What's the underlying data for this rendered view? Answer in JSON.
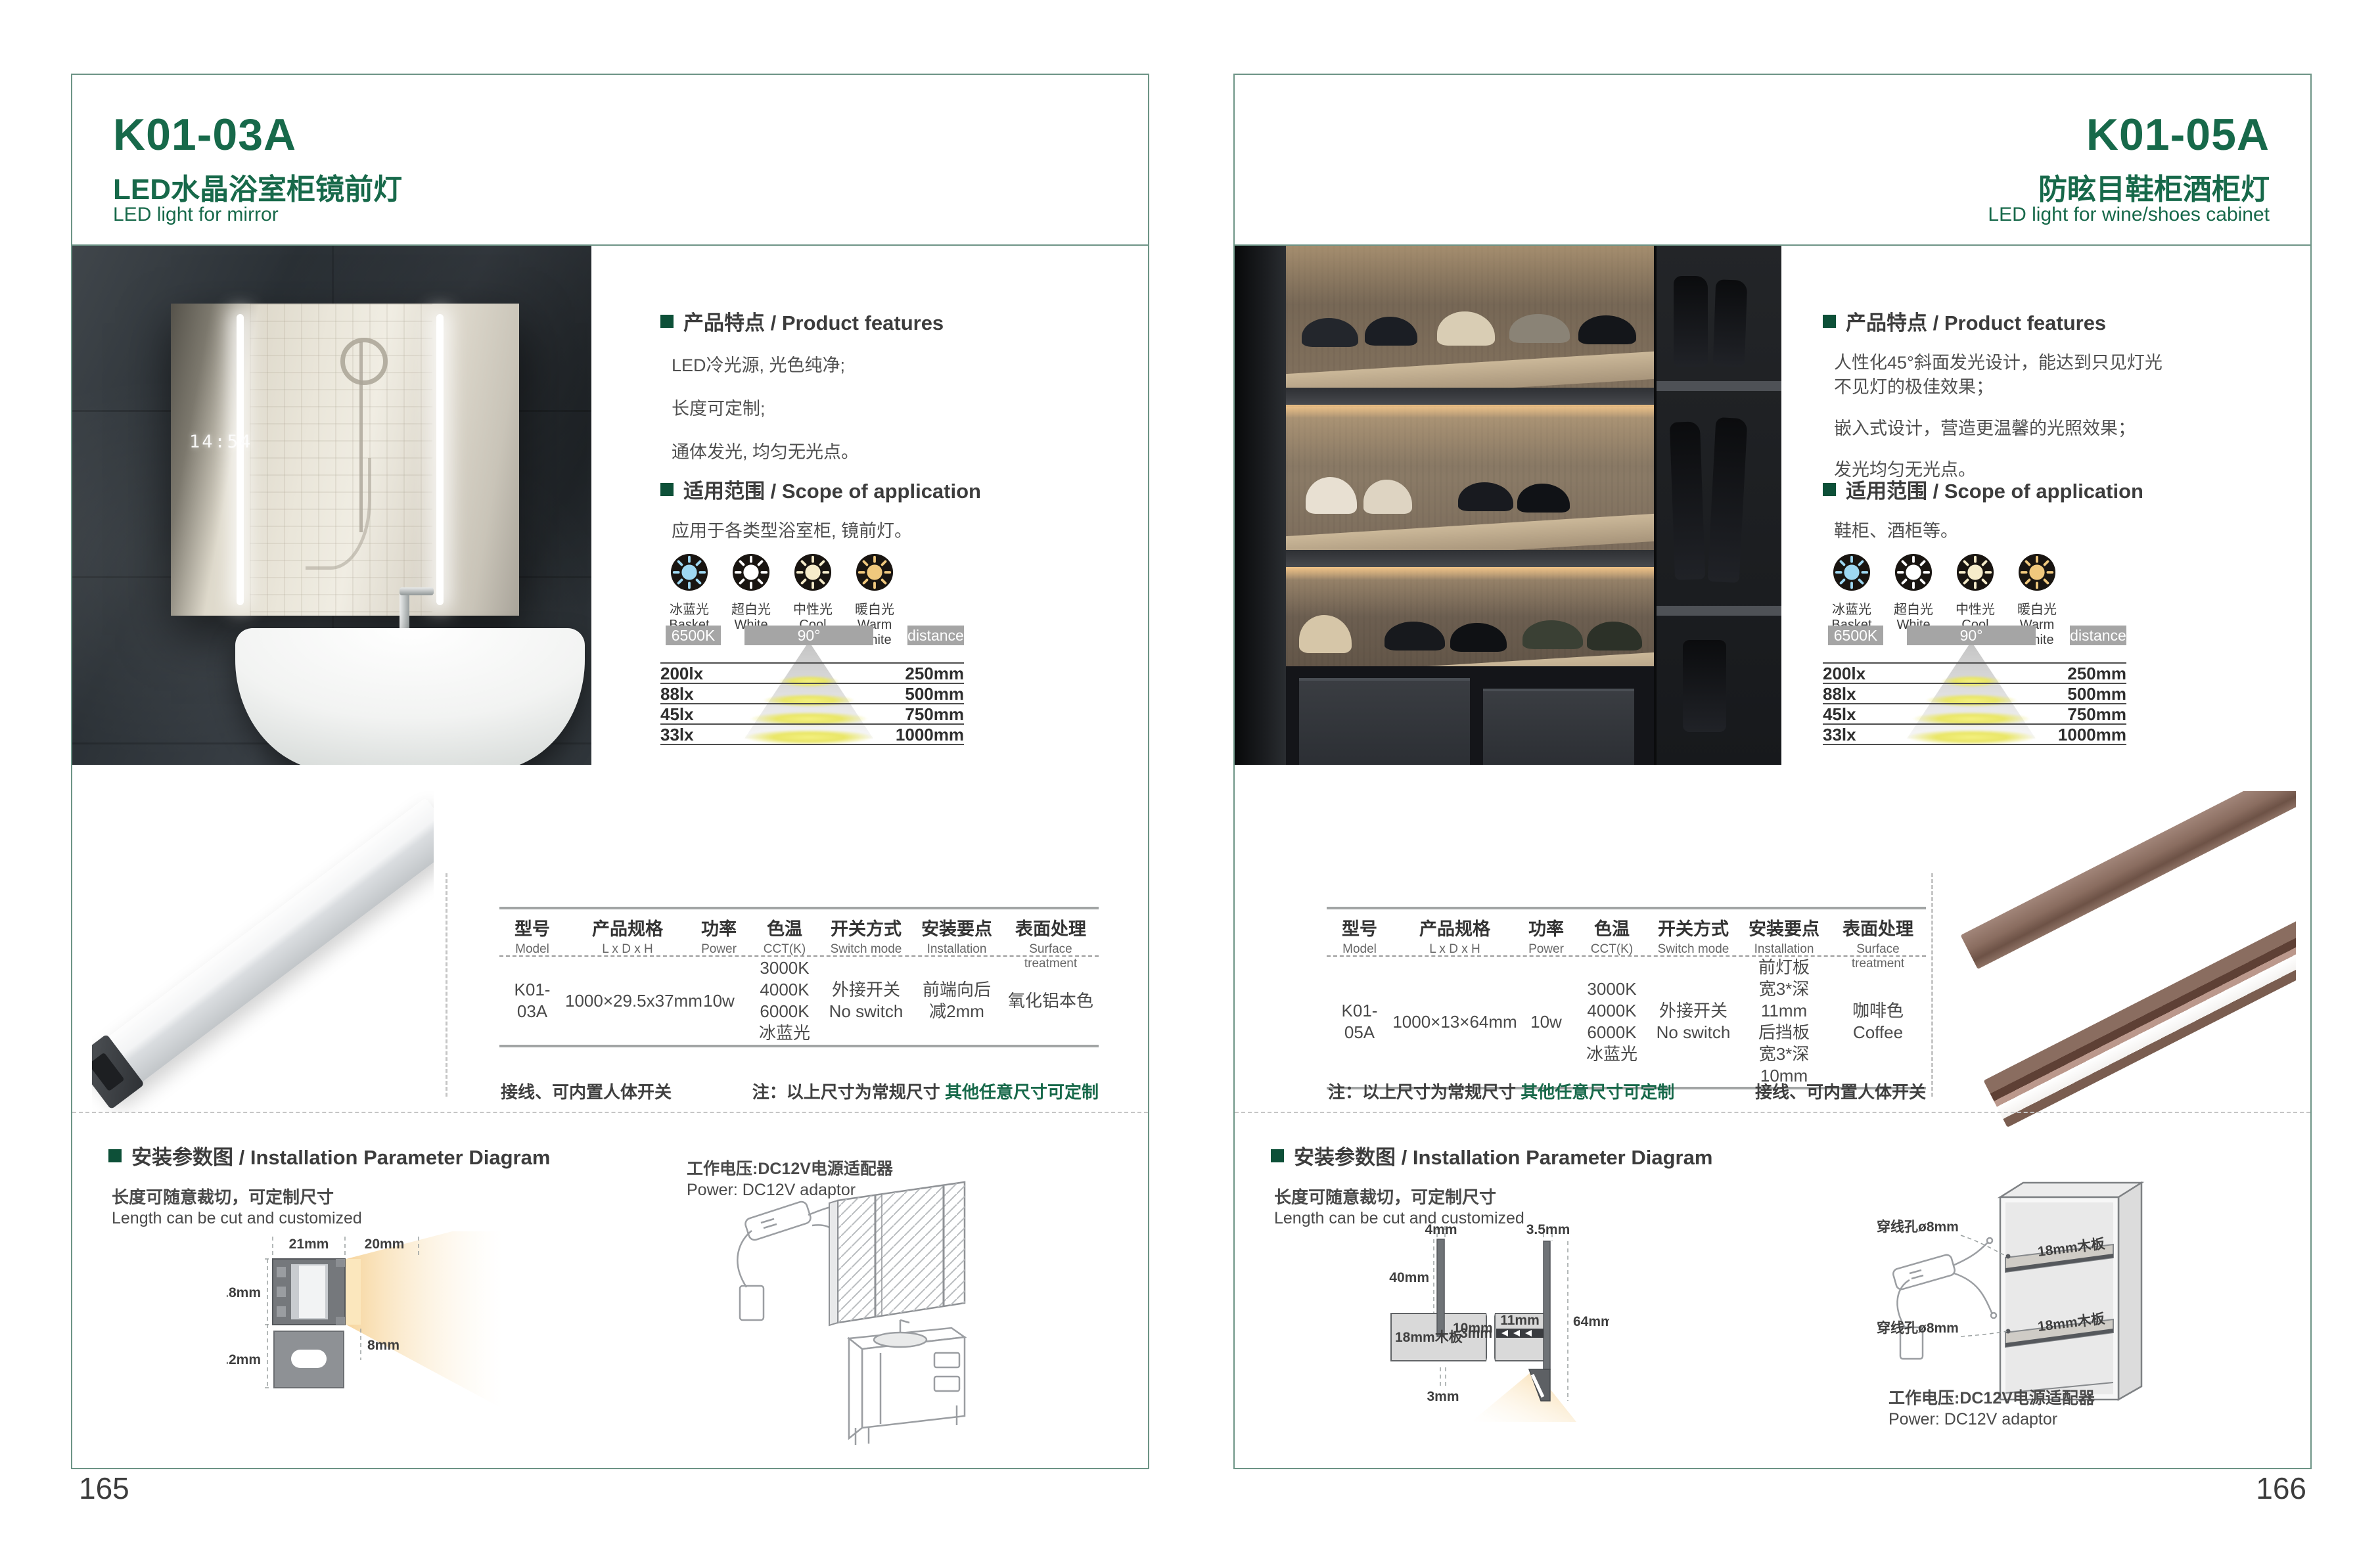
{
  "brand": {
    "green": "#17694a",
    "frame_teal": "#6d9486",
    "note_green": "#17694a"
  },
  "shared": {
    "features_title": "产品特点 / Product features",
    "scope_title": "适用范围 / Scope of application",
    "light_options": [
      {
        "cn": "冰蓝光",
        "en": "Basket",
        "color": "#9ed8f2"
      },
      {
        "cn": "超白光",
        "en": "White",
        "color": "#ffffff"
      },
      {
        "cn": "中性光",
        "en": "Cool White",
        "color": "#f6ecca"
      },
      {
        "cn": "暖白光",
        "en": "Warm White",
        "color": "#f0c87d"
      }
    ],
    "beam_chart": {
      "type": "table",
      "cct_label": "6500K",
      "angle_label": "90°",
      "distance_label": "distance",
      "rows": [
        {
          "lux": "200lx",
          "distance": "250mm"
        },
        {
          "lux": "88lx",
          "distance": "500mm"
        },
        {
          "lux": "45lx",
          "distance": "750mm"
        },
        {
          "lux": "33lx",
          "distance": "1000mm"
        }
      ]
    },
    "table_headers": [
      {
        "cn": "型号",
        "en": "Model"
      },
      {
        "cn": "产品规格",
        "en": "L x D x H"
      },
      {
        "cn": "功率",
        "en": "Power"
      },
      {
        "cn": "色温",
        "en": "CCT(K)"
      },
      {
        "cn": "开关方式",
        "en": "Switch mode"
      },
      {
        "cn": "安装要点",
        "en": "Installation"
      },
      {
        "cn": "表面处理",
        "en": "Surface treatment"
      }
    ],
    "note_wire": "接线、可内置人体开关",
    "note_size_prefix": "注：以上尺寸为常规尺寸 ",
    "note_size_custom": "其他任意尺寸可定制",
    "install_title": "安装参数图 / Installation Parameter Diagram",
    "cut_cn": "长度可随意裁切，可定制尺寸",
    "cut_en": "Length can be cut and customized",
    "power_cn": "工作电压:DC12V电源适配器",
    "power_en": "Power: DC12V adaptor"
  },
  "left_page": {
    "model": "K01-03A",
    "title_cn": "LED水晶浴室柜镜前灯",
    "title_en": "LED light for mirror",
    "page_number": "165",
    "features": [
      "LED冷光源, 光色纯净;",
      "长度可定制;",
      "通体发光, 均匀无光点。"
    ],
    "scope": "应用于各类型浴室柜, 镜前灯。",
    "mirror_clock": "14:54",
    "spec": {
      "model": "K01-03A",
      "size": "1000×29.5x37mm",
      "power": "10w",
      "cct": [
        "3000K",
        "4000K",
        "6000K",
        "冰蓝光"
      ],
      "switch": [
        "外接开关",
        "No switch"
      ],
      "install": [
        "前端向后",
        "减2mm"
      ],
      "surface": [
        "氧化铝本色"
      ]
    },
    "diagram": {
      "top_width": "21mm",
      "beam_width": "20mm",
      "body_height": "14.8mm",
      "bracket_height": "12.2mm",
      "beam_offset": "8mm"
    }
  },
  "right_page": {
    "model": "K01-05A",
    "title_cn": "防眩目鞋柜酒柜灯",
    "title_en": "LED light for wine/shoes cabinet",
    "page_number": "166",
    "features": [
      "人性化45°斜面发光设计，能达到只见灯光",
      "不见灯的极佳效果；",
      "嵌入式设计，营造更温馨的光照效果；",
      "发光均匀无光点。"
    ],
    "scope": "鞋柜、酒柜等。",
    "spec": {
      "model": "K01-05A",
      "size": "1000×13×64mm",
      "power": "10w",
      "cct": [
        "3000K",
        "4000K",
        "6000K",
        "冰蓝光"
      ],
      "switch": [
        "外接开关",
        "No switch"
      ],
      "install": [
        "前灯板",
        "宽3*深11mm",
        "后挡板",
        "宽3*深10mm"
      ],
      "surface": [
        "咖啡色",
        "Coffee"
      ]
    },
    "diagram": {
      "front_panel": "4mm",
      "rear_panel": "3.5mm",
      "panel_height": "40mm",
      "groove_depth": "10mm",
      "board": "18mm木板",
      "groove_width": "3mm",
      "strip_width": "11mm",
      "strip_thickness": "3mm",
      "total_height": "64mm"
    },
    "cabinet": {
      "hole_label": "穿线孔ø8mm",
      "hole_label2": "穿线孔ø8mm",
      "shelf_label": "18mm木板",
      "shelf_label2": "18mm木板"
    }
  }
}
